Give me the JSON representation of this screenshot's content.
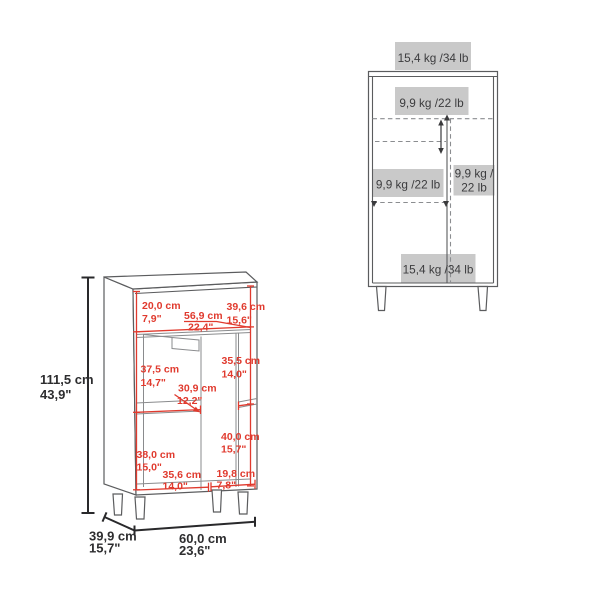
{
  "colors": {
    "dimension_red": "#e03a2e",
    "label_background": "#c9c9c9",
    "outline_gray": "#5b5c5e",
    "text_dark": "#2d2d2f"
  },
  "front_view": {
    "load_top": "15,4 kg /34 lb",
    "load_upper_shelf": "9,9 kg /22 lb",
    "load_left_cabinet": "9,9 kg /22 lb",
    "load_right_shelf_l1": "9,9 kg /",
    "load_right_shelf_l2": "22 lb",
    "load_bottom": "15,4 kg /34 lb"
  },
  "dimensions": {
    "overall_height_cm": "111,5 cm",
    "overall_height_in": "43,9\"",
    "depth_cm": "39,9 cm",
    "depth_in": "15,7\"",
    "width_cm": "60,0 cm",
    "width_in": "23,6\"",
    "top_section_height_cm": "20,0 cm",
    "top_section_height_in": "7,9\"",
    "interior_width_cm": "56,9 cm",
    "interior_width_in": "22,4\"",
    "interior_depth_cm": "39,6 cm",
    "interior_depth_in": "15,6\"",
    "mid_left_height_cm": "37,5 cm",
    "mid_left_height_in": "14,7\"",
    "mid_right_height_cm": "35,5 cm",
    "mid_right_height_in": "14,0\"",
    "center_width_cm": "30,9 cm",
    "center_width_in": "12,2\"",
    "bottom_left_height_cm": "38,0 cm",
    "bottom_left_height_in": "15,0\"",
    "bottom_right_height_cm": "40,0 cm",
    "bottom_right_height_in": "15,7\"",
    "bottom_left_width_cm": "35,6 cm",
    "bottom_left_width_in": "14,0\"",
    "bottom_right_width_cm": "19,8 cm",
    "bottom_right_width_in": "7,8\""
  }
}
